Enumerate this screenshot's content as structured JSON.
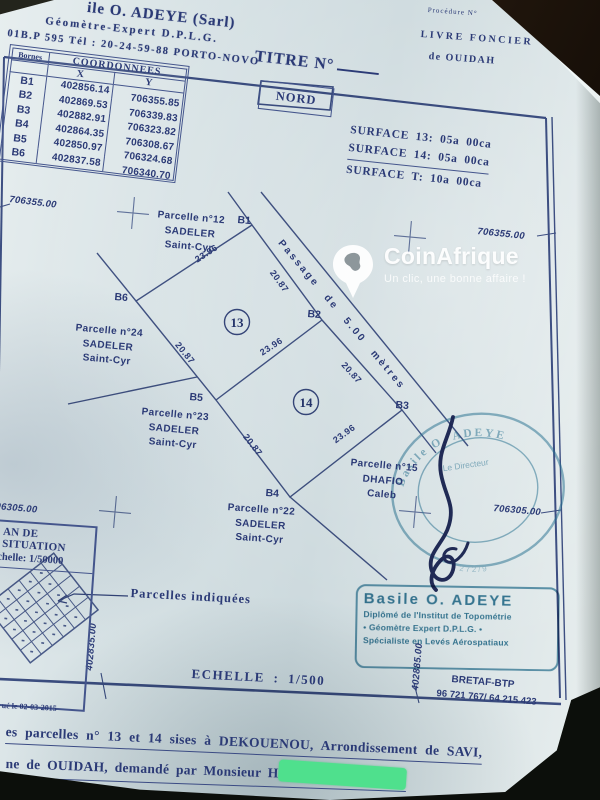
{
  "colors": {
    "photo_bg": "#17100b",
    "ink": "#2b3a76",
    "line": "#44558c",
    "stamp": "#2e7d9e",
    "signature": "#1a2456",
    "redaction": "#4fe08d"
  },
  "header": {
    "firm_line": "ile O. ADEYE (Sarl)",
    "role_line": "Géomètre-Expert D.P.L.G.",
    "address_line": "01B.P 595 Tél : 20-24-59-88 PORTO-NOVO",
    "procedure_label": "Procédure N°",
    "livre_foncier": "LIVRE FONCIER",
    "de_ouidah": "de OUIDAH",
    "titre_label": "TITRE N°",
    "nord_label": "NORD"
  },
  "coordinates_table": {
    "title": "COORDONNEES",
    "col_bornes": "Bornes",
    "col_x": "X",
    "col_y": "Y",
    "rows": [
      {
        "borne": "B1",
        "x": "402856.14",
        "y": "706355.85"
      },
      {
        "borne": "B2",
        "x": "402869.53",
        "y": "706339.83"
      },
      {
        "borne": "B3",
        "x": "402882.91",
        "y": "706323.82"
      },
      {
        "borne": "B4",
        "x": "402864.35",
        "y": "706308.67"
      },
      {
        "borne": "B5",
        "x": "402850.97",
        "y": "706324.68"
      },
      {
        "borne": "B6",
        "x": "402837.58",
        "y": "706340.70"
      }
    ]
  },
  "surfaces": {
    "line1": "SURFACE 13: 05a 00ca",
    "line2": "SURFACE 14: 05a 00ca",
    "line3": "SURFACE T: 10a 00ca"
  },
  "plan": {
    "grid_labels": {
      "top_left": "706355.00",
      "top_right": "706355.00",
      "bottom_left": "06305.00",
      "bottom_right": "706305.00",
      "x_left": "402835.00",
      "x_right": "402885.00"
    },
    "passage_label": "Passage de 5.00 mètres",
    "lot_numbers": [
      "13",
      "14"
    ],
    "bornes": [
      "B1",
      "B2",
      "B3",
      "B4",
      "B5",
      "B6"
    ],
    "measurements": {
      "b6b1": "23.96",
      "b1b2": "20.87",
      "b6b5": "20.87",
      "b5b2": "23.96",
      "b2b3": "20.87",
      "b5b4": "20.87",
      "b4b3": "23.96"
    },
    "parcels": {
      "p12": {
        "name": "Parcelle n°12",
        "owner": "SADELER",
        "owner2": "Saint-Cyr"
      },
      "p24": {
        "name": "Parcelle n°24",
        "owner": "SADELER",
        "owner2": "Saint-Cyr"
      },
      "p23": {
        "name": "Parcelle n°23",
        "owner": "SADELER",
        "owner2": "Saint-Cyr"
      },
      "p22": {
        "name": "Parcelle n°22",
        "owner": "SADELER",
        "owner2": "Saint-Cyr"
      },
      "p15": {
        "name": "Parcelle n°15",
        "owner": "DHAFIO",
        "owner2": "Caleb"
      }
    }
  },
  "situation": {
    "title": "AN DE SITUATION",
    "scale": "chelle: 1/50000",
    "callout": "Parcelles indiquées"
  },
  "scale_label": "ECHELLE : 1/500",
  "stamps": {
    "rect": {
      "name": "Basile O. ADEYE",
      "line2": "Diplômé de l'Institut de Topométrie",
      "line3": "• Géomètre Expert D.P.L.G. •",
      "line4": "Spécialiste en Levés Aérospatiaux"
    },
    "round": {
      "top": "Basile O. ADEYE",
      "center": "Le Directeur",
      "bottom": "272/9"
    },
    "bretaf": "BRETAF-BTP",
    "phone": "96 721 767/ 64 215 423"
  },
  "footer": {
    "date_line": "ué  le  02-03-2015",
    "line1": "es parcelles n° 13 et 14 sises à DEKOUENOU, Arrondissement de SAVI,",
    "line2": "ne de OUIDAH, demandé par Monsieur ",
    "name_prefix": "H"
  },
  "watermark": {
    "brand": "CoinAfrique",
    "tagline": "Un clic, une bonne affaire !"
  }
}
